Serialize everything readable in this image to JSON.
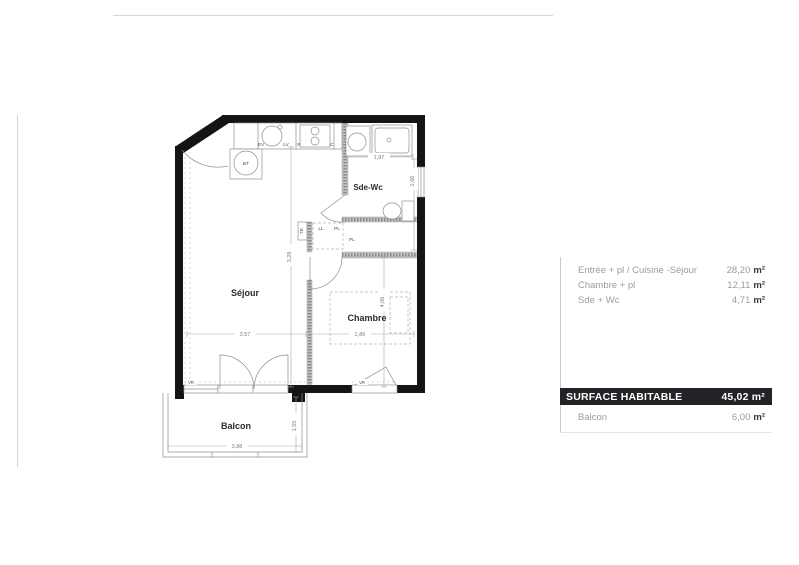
{
  "plan": {
    "rooms": {
      "sejour": "Séjour",
      "chambre": "Chambre",
      "sde_wc": "Sde-Wc",
      "balcon": "Balcon"
    },
    "fixtures": {
      "bt": "BT",
      "ev": "EV",
      "lv": "LV",
      "r": "R",
      "c": "C",
      "te": "TE",
      "ll": "LL",
      "pl_closet": "PL",
      "pl_hall": "PL",
      "vr_left": "VR",
      "vr_right": "VR"
    },
    "dimensions": {
      "sde_width": "1,97",
      "sde_height": "2,66",
      "entree_height": "3,28",
      "sejour_width": "3,57",
      "chambre_width": "2,86",
      "chambre_height": "4,06",
      "balcon_width": "3,88",
      "balcon_depth": "1,55"
    }
  },
  "surface_table": {
    "rows": [
      {
        "label": "Entrée + pl / Cuisine -Séjour",
        "value": "28,20",
        "unit": "m²"
      },
      {
        "label": "Chambre + pl",
        "value": "12,11",
        "unit": "m²"
      },
      {
        "label": "Sde + Wc",
        "value": "4,71",
        "unit": "m²"
      }
    ],
    "total": {
      "label": "SURFACE HABITABLE",
      "value": "45,02",
      "unit": "m²"
    },
    "balcony": {
      "label": "Balcon",
      "value": "6,00",
      "unit": "m²"
    }
  },
  "colors": {
    "wall": "#141414",
    "partition": "#c6c6c6",
    "accent_bar": "#222227",
    "muted_text": "#9c9c9c"
  }
}
